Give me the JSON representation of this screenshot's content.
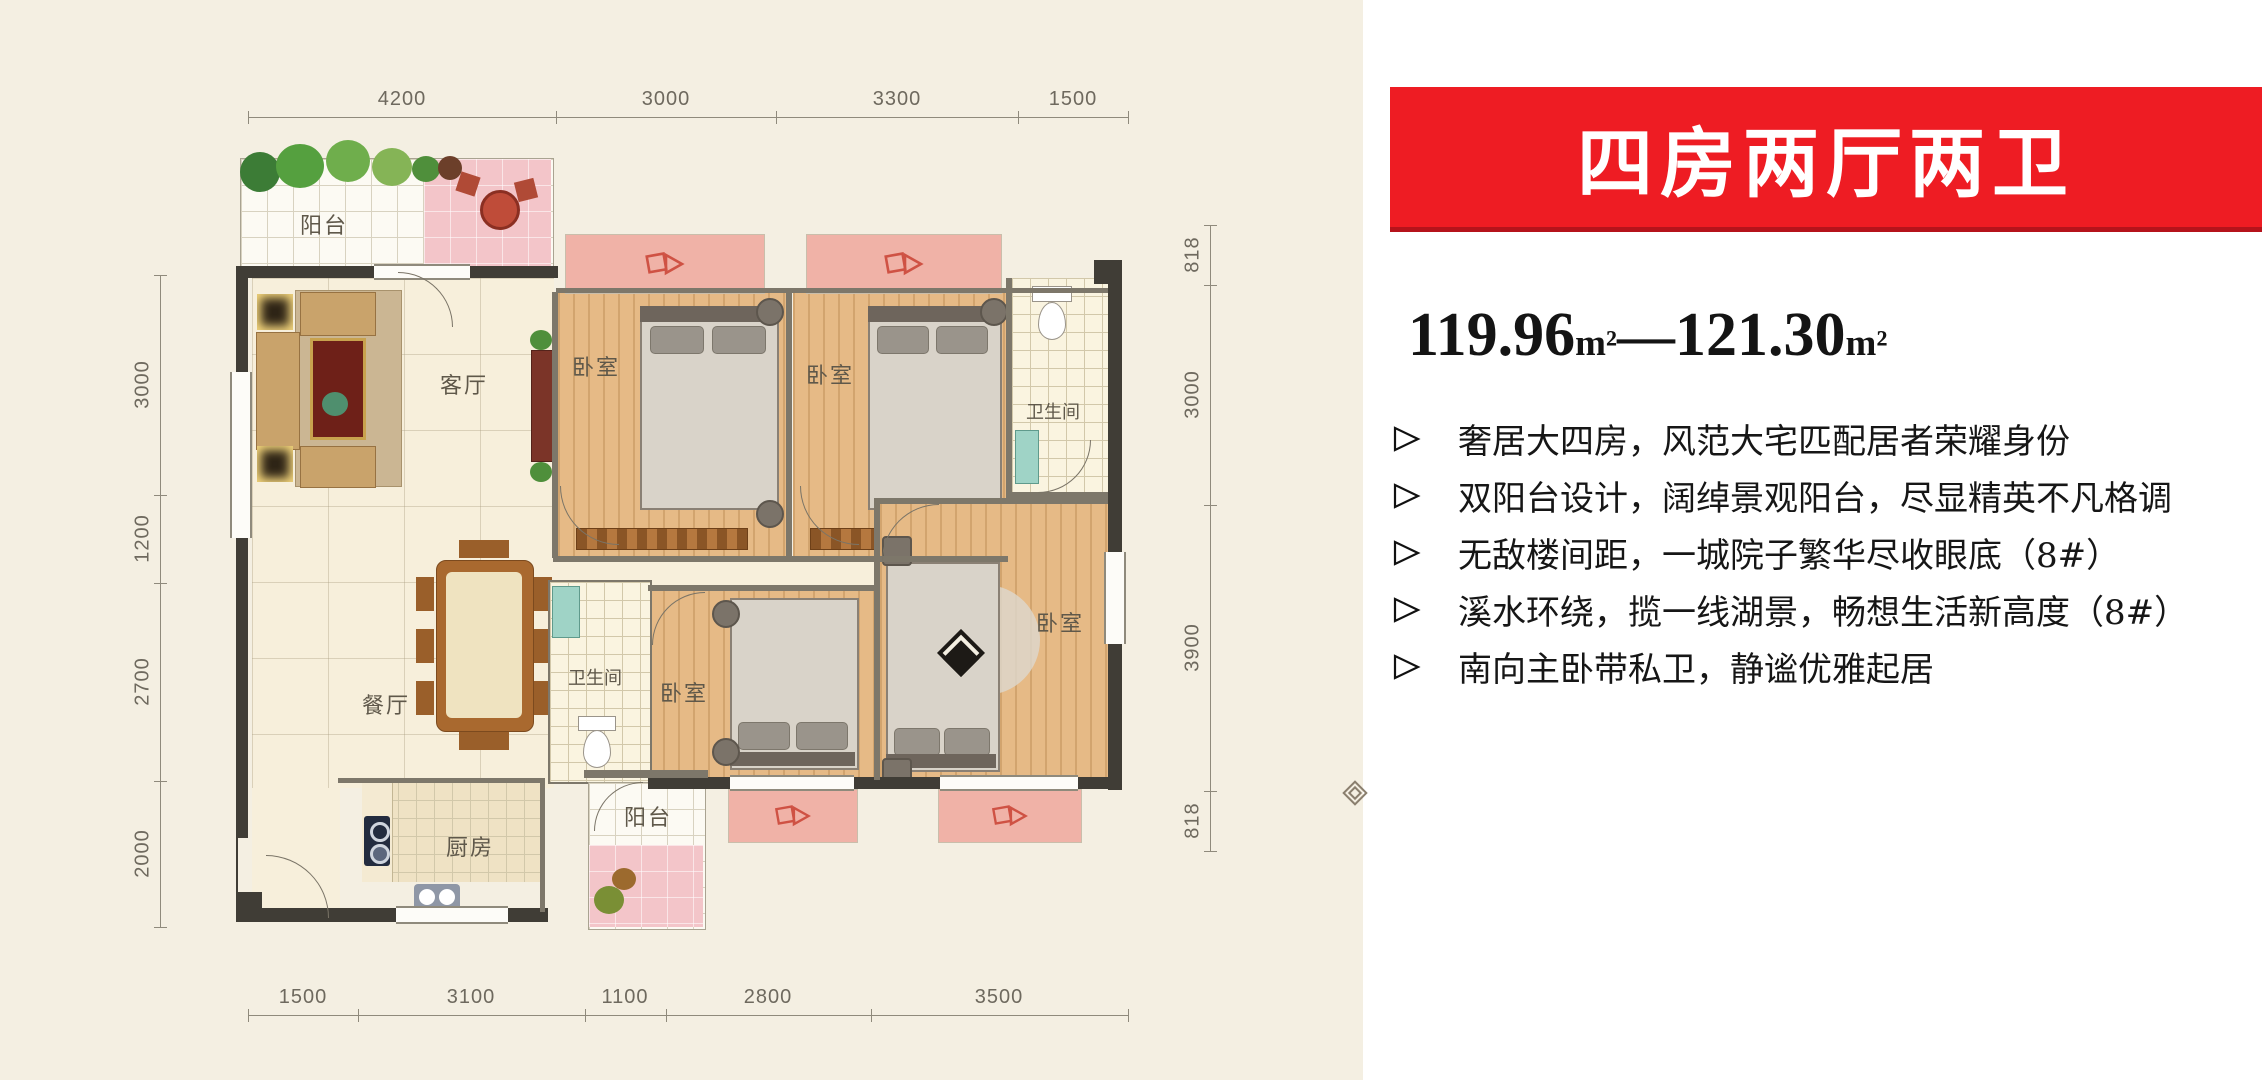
{
  "plan": {
    "dims": {
      "top": [
        "4200",
        "3000",
        "3300",
        "1500"
      ],
      "bottom": [
        "1500",
        "3100",
        "1100",
        "2800",
        "3500"
      ],
      "left": [
        "3000",
        "1200",
        "2700",
        "2000"
      ],
      "right": [
        "818",
        "3000",
        "3900",
        "818"
      ]
    },
    "rooms": {
      "balcony_top": "阳台",
      "living": "客厅",
      "dining": "餐厅",
      "kitchen": "厨房",
      "balcony_bottom": "阳台",
      "bedroom_1": "卧室",
      "bedroom_2": "卧室",
      "bedroom_3": "卧室",
      "master_bedroom": "卧室",
      "bathroom_1": "卫生间",
      "bathroom_2": "卫生间"
    },
    "colors": {
      "sheet_background": "#f4efe2",
      "wood_floor": "#e6ba86",
      "bay_window_pink": "#f0b2a7",
      "wall_dark": "#403d36",
      "arrow_red": "#cf5244"
    }
  },
  "panel": {
    "banner_title": "四房两厅两卫",
    "area": {
      "min": "119.96",
      "unit": "m²",
      "separator": "—",
      "max": "121.30"
    },
    "features": [
      "奢居大四房，风范大宅匹配居者荣耀身份",
      "双阳台设计，阔绰景观阳台，尽显精英不凡格调",
      "无敌楼间距，一城院子繁华尽收眼底（8#）",
      "溪水环绕，揽一线湖景，畅想生活新高度（8#）",
      "南向主卧带私卫，静谧优雅起居"
    ],
    "colors": {
      "banner_bg": "#ee1c23",
      "banner_text": "#ffffff"
    }
  }
}
